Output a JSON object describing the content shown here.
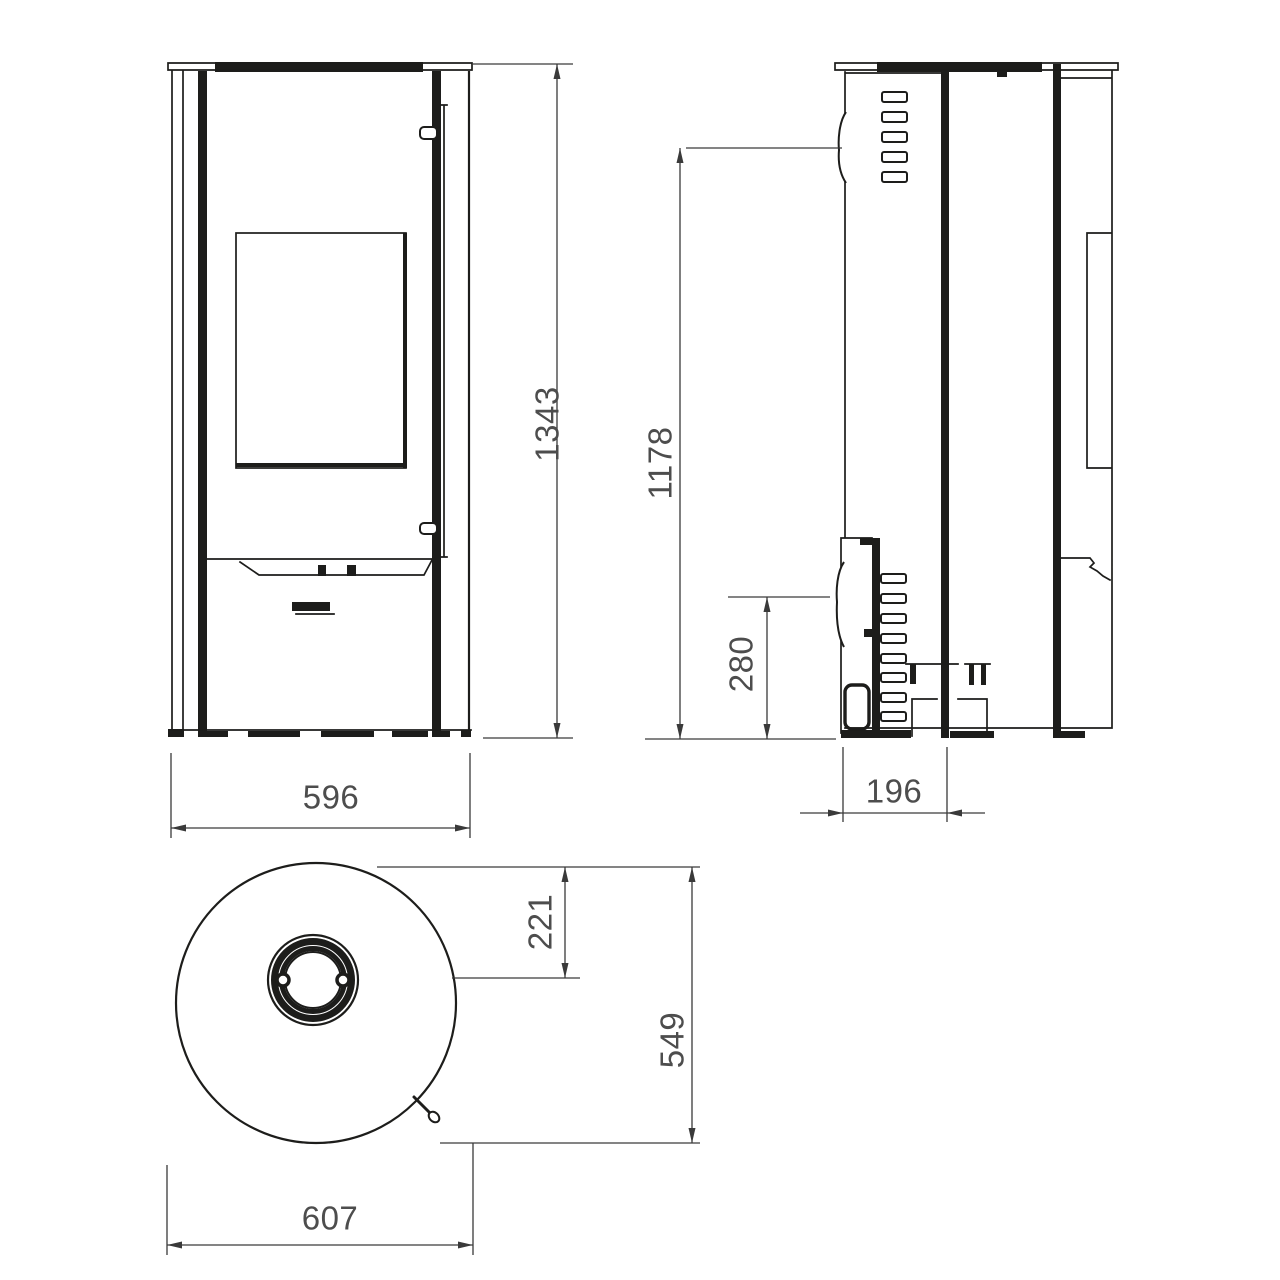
{
  "drawing": {
    "type": "stove-dimension-drawing",
    "colors": {
      "line": "#1d1d1b",
      "dimension_line": "#3a3a3a",
      "dimension_text": "#4d4d4d",
      "background": "#ffffff"
    },
    "dimensions": {
      "height_total": "1343",
      "width_front": "596",
      "height_rear_upper": "1178",
      "height_side_lower": "280",
      "depth_door_section": "196",
      "flue_center_offset": "221",
      "depth_total": "549",
      "width_top_view": "607"
    }
  }
}
